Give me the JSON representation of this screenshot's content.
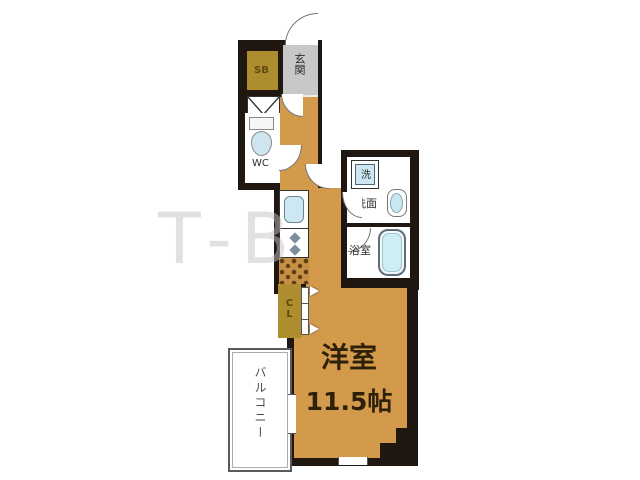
{
  "plan": {
    "type": "apartment-floor-plan",
    "watermark": "T-B",
    "labels": {
      "main_room": "洋室",
      "main_room_size": "11.5帖",
      "balcony": "バルコニー",
      "entrance": "玄関",
      "shoe_box": "SB",
      "toilet": "WC",
      "closet": "CL",
      "laundry": "洗",
      "washroom": "洗面",
      "bathroom": "浴室"
    },
    "colors": {
      "floor": "#d49a4c",
      "wall": "#201710",
      "storage": "#ae8d2f",
      "entrance_floor": "#c8c8c8",
      "fixture_blue": "#cde8f2",
      "tub_blue": "#cdeff3",
      "balcony_border": "#5a5a5a"
    }
  }
}
